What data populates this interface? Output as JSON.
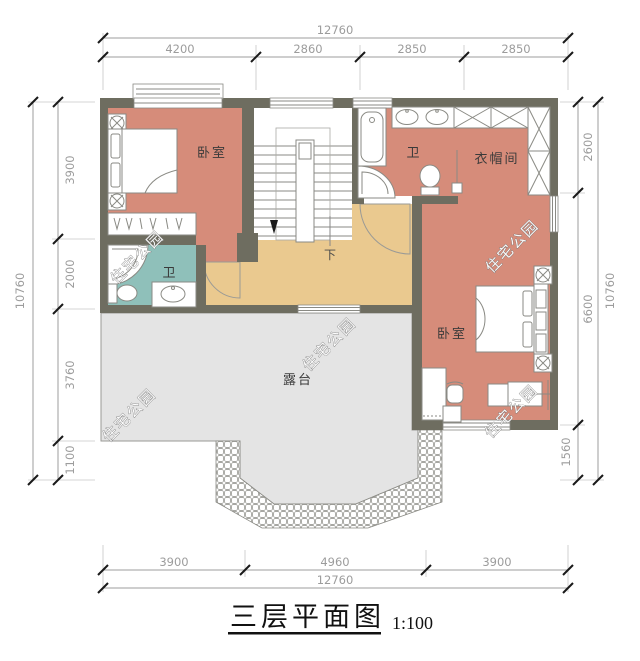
{
  "title": {
    "main": "三层平面图",
    "scale": "1:100"
  },
  "dimensions": {
    "top": {
      "overall": "12760",
      "segments": [
        "4200",
        "2860",
        "2850",
        "2850"
      ]
    },
    "bottom": {
      "overall": "12760",
      "segments": [
        "3900",
        "4960",
        "3900"
      ]
    },
    "left": {
      "overall": "10760",
      "segments": [
        "3900",
        "2000",
        "3760",
        "1100"
      ]
    },
    "right": {
      "overall": "10760",
      "segments": [
        "2600",
        "6600",
        "1560"
      ]
    }
  },
  "rooms": {
    "bedroom_left": "卧室",
    "bedroom_right": "卧室",
    "bath_left": "卫",
    "bath_right": "卫",
    "cloakroom": "衣帽间",
    "terrace": "露台",
    "stair_down": "下"
  },
  "watermark": "住宅公园",
  "colors": {
    "wall": "#6E6D60",
    "room_fill": "#D68C7A",
    "bath_fill": "#8FC0BA",
    "hall_fill": "#EAC98F",
    "terrace_fill": "#E4E4E4"
  }
}
